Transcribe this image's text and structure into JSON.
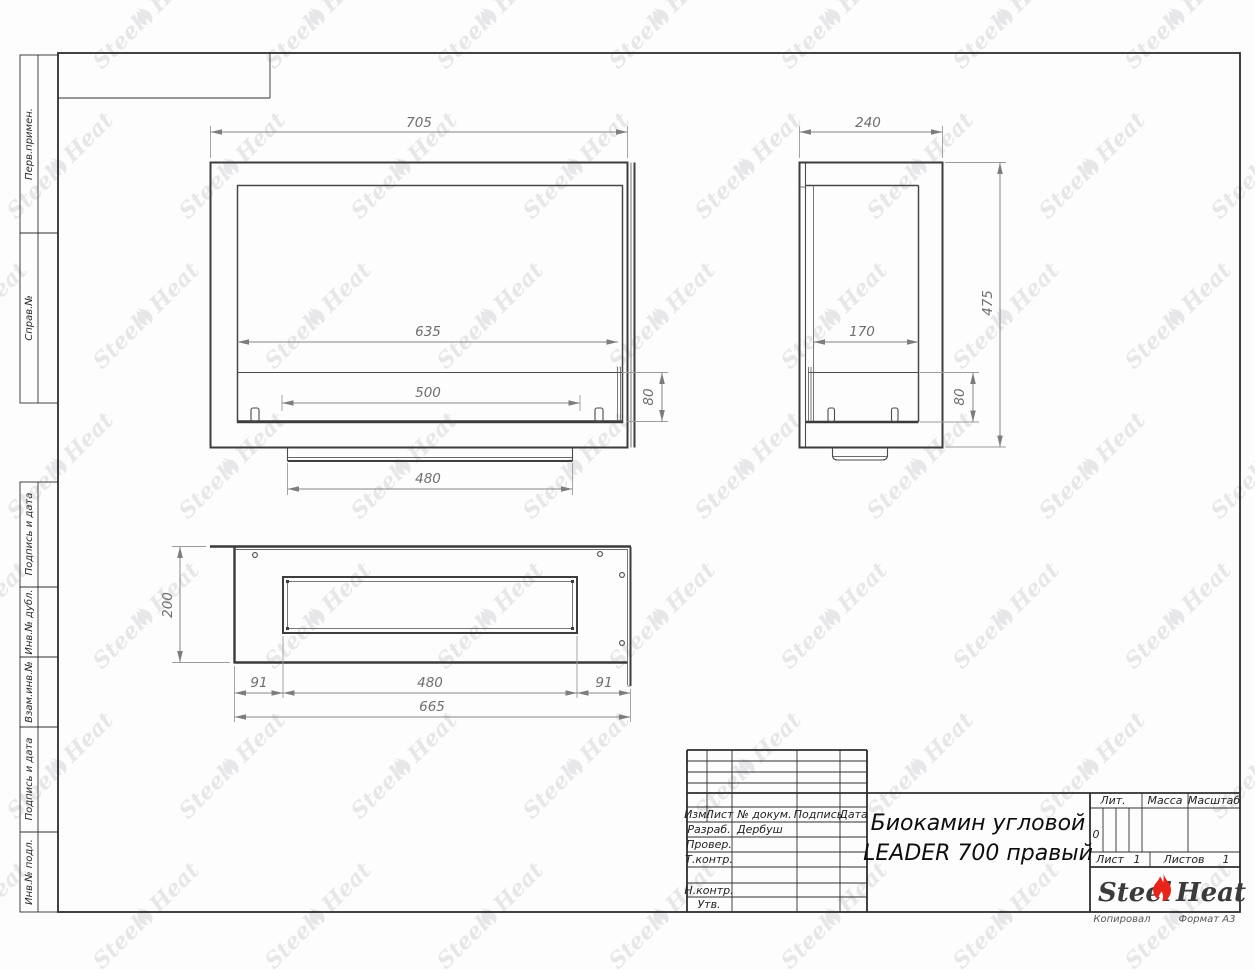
{
  "sheet": {
    "copied_label": "Копировал",
    "format_label": "Формат А3"
  },
  "watermark": {
    "left": "Steel",
    "right": "Heat"
  },
  "margin_labels": {
    "perv_primen": "Перв.примен.",
    "sprav_no": "Справ.№",
    "podpis_data_1": "Подпись и дата",
    "inv_dubl": "Инв.№ дубл.",
    "vzam_inv": "Взам.инв.№",
    "podpis_data_2": "Подпись и дата",
    "inv_podl": "Инв.№ подл."
  },
  "title_block": {
    "col_izm": "Изм.",
    "col_list": "Лист",
    "col_doc": "№ докум.",
    "col_sign": "Подпись",
    "col_date": "Дата",
    "row_razrab": "Разраб.",
    "razrab_value": "Дербуш",
    "row_prover": "Провер.",
    "row_tkontr": "Т.контр.",
    "row_nkontr": "Н.контр.",
    "row_utv": "Утв.",
    "title_line1": "Биокамин угловой",
    "title_line2": "LEADER 700 правый",
    "lit_label": "Лит.",
    "lit_value": "0",
    "mass_label": "Масса",
    "scale_label": "Масштаб",
    "sheet_label": "Лист",
    "sheet_value": "1",
    "sheets_label": "Листов",
    "sheets_value": "1",
    "logo_left": "Steel",
    "logo_right": "Heat"
  },
  "dimensions": {
    "front": {
      "width": "705",
      "opening": "635",
      "burner": "500",
      "tray": "80",
      "base": "480"
    },
    "side": {
      "depth": "240",
      "opening": "170",
      "height": "475",
      "tray": "80"
    },
    "top": {
      "depth": "200",
      "left": "91",
      "slot": "480",
      "right": "91",
      "total": "665"
    }
  },
  "colors": {
    "flame_red": "#e8231a",
    "watermark_gray": "#e7e7ea",
    "line_dark": "#3d3d3d"
  }
}
